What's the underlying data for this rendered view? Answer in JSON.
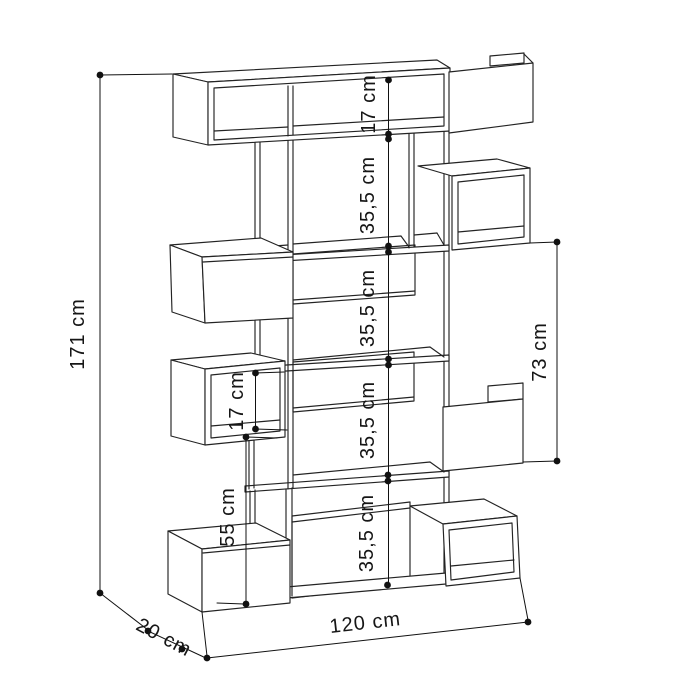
{
  "diagram": {
    "type": "furniture-dimension-drawing",
    "subject": "staggered cube bookcase line drawing with dimension callouts",
    "unit": "cm",
    "dimensions": {
      "height": {
        "value": 171,
        "label": "171 cm"
      },
      "top_gap": {
        "value": 17,
        "label": "17 cm"
      },
      "shelf_gap_1": {
        "value": 35.5,
        "label": "35,5 cm"
      },
      "shelf_gap_2": {
        "value": 35.5,
        "label": "35,5 cm"
      },
      "shelf_gap_3": {
        "value": 35.5,
        "label": "35,5 cm"
      },
      "shelf_gap_4": {
        "value": 35.5,
        "label": "35,5 cm"
      },
      "right_span": {
        "value": 73,
        "label": "73 cm"
      },
      "middle_box_gap": {
        "value": 17,
        "label": "17 cm"
      },
      "lower_span": {
        "value": 55,
        "label": "55 cm"
      },
      "depth": {
        "value": 20,
        "label": "20 cm"
      },
      "width": {
        "value": 120,
        "label": "120 cm"
      }
    }
  }
}
